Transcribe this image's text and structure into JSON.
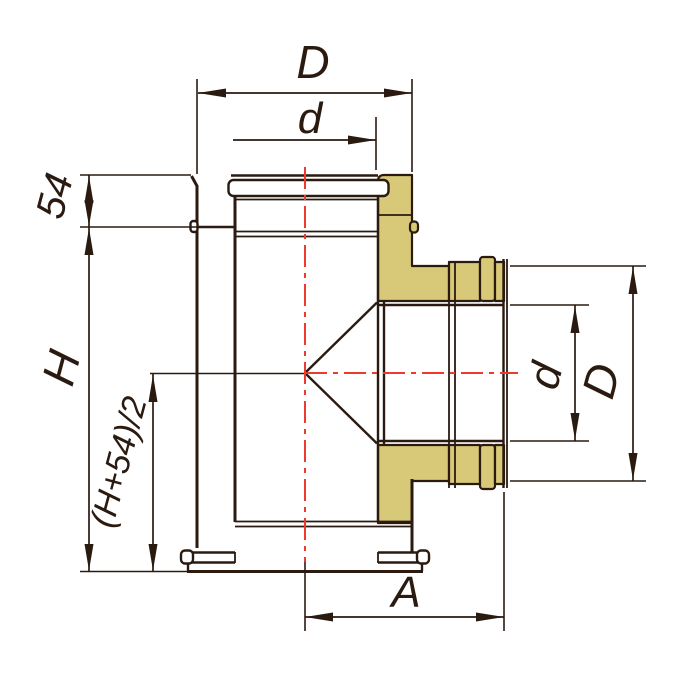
{
  "figure": {
    "kind": "technical-drawing",
    "subject": "insulated sandwich tee 90deg - section view",
    "colors": {
      "line": "#2a1a10",
      "centerline_red": "#ee3a2e",
      "insulation_fill": "#d7c977",
      "background": "#ffffff"
    },
    "dimensions": {
      "top_outer_diameter": "D",
      "top_inner_diameter": "d",
      "socket_depth": "54",
      "body_height": "H",
      "axis_height_formula": "(H+54)/2",
      "branch_length": "A",
      "branch_inner_diameter": "d",
      "branch_outer_diameter": "D"
    }
  }
}
